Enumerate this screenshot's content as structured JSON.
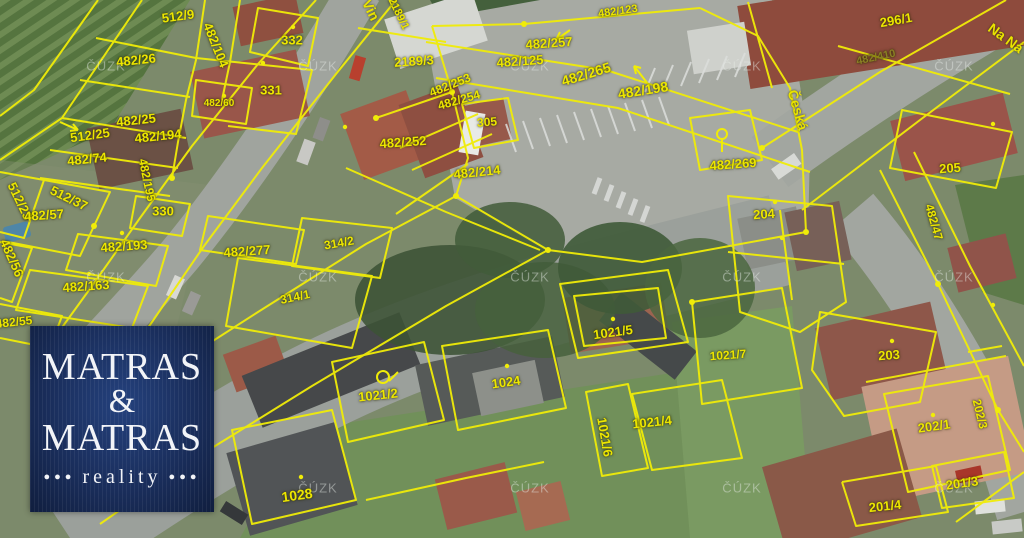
{
  "map": {
    "watermark": {
      "text": "ČÚZK",
      "grid_x": [
        106,
        318,
        530,
        742,
        954
      ],
      "grid_y": [
        66,
        277,
        488
      ]
    },
    "street_labels": [
      {
        "t": "Vin",
        "x": 371,
        "y": 10,
        "r": 64,
        "s": 14
      },
      {
        "t": "Česká",
        "x": 798,
        "y": 110,
        "r": 74,
        "s": 14
      },
      {
        "t": "Na Ná",
        "x": 1006,
        "y": 38,
        "r": 36,
        "s": 14
      }
    ],
    "parcel_labels": [
      {
        "t": "512/9",
        "x": 178,
        "y": 16,
        "r": -8,
        "s": 13
      },
      {
        "t": "482/104",
        "x": 216,
        "y": 45,
        "r": 68,
        "s": 13
      },
      {
        "t": "332",
        "x": 292,
        "y": 40,
        "r": 0,
        "s": 13
      },
      {
        "t": "482/26",
        "x": 136,
        "y": 60,
        "r": -6,
        "s": 13
      },
      {
        "t": "331",
        "x": 271,
        "y": 90,
        "r": 0,
        "s": 13
      },
      {
        "t": "482/60",
        "x": 219,
        "y": 104,
        "r": 0,
        "s": 10
      },
      {
        "t": "482/25",
        "x": 136,
        "y": 120,
        "r": -6,
        "s": 13
      },
      {
        "t": "512/25",
        "x": 90,
        "y": 135,
        "r": -8,
        "s": 13
      },
      {
        "t": "482/194",
        "x": 158,
        "y": 136,
        "r": -6,
        "s": 13
      },
      {
        "t": "482/74",
        "x": 87,
        "y": 159,
        "r": -6,
        "s": 13
      },
      {
        "t": "482/195",
        "x": 147,
        "y": 180,
        "r": 78,
        "s": 12
      },
      {
        "t": "512/23",
        "x": 20,
        "y": 201,
        "r": 64,
        "s": 13
      },
      {
        "t": "512/37",
        "x": 69,
        "y": 198,
        "r": 26,
        "s": 13
      },
      {
        "t": "482/57",
        "x": 44,
        "y": 215,
        "r": -4,
        "s": 13
      },
      {
        "t": "330",
        "x": 163,
        "y": 211,
        "r": 0,
        "s": 13
      },
      {
        "t": "482/193",
        "x": 124,
        "y": 246,
        "r": -4,
        "s": 13
      },
      {
        "t": "482/277",
        "x": 247,
        "y": 251,
        "r": -4,
        "s": 13
      },
      {
        "t": "482/56",
        "x": 12,
        "y": 258,
        "r": 66,
        "s": 13
      },
      {
        "t": "482/163",
        "x": 86,
        "y": 286,
        "r": -4,
        "s": 13
      },
      {
        "t": "314/2",
        "x": 339,
        "y": 243,
        "r": -10,
        "s": 12
      },
      {
        "t": "314/1",
        "x": 295,
        "y": 297,
        "r": -12,
        "s": 12
      },
      {
        "t": "482/55",
        "x": 14,
        "y": 322,
        "r": -6,
        "s": 12
      },
      {
        "t": "2189/1",
        "x": 398,
        "y": 14,
        "r": 64,
        "s": 11
      },
      {
        "t": "2189/3",
        "x": 414,
        "y": 61,
        "r": -4,
        "s": 13
      },
      {
        "t": "482/123",
        "x": 618,
        "y": 12,
        "r": -8,
        "s": 11
      },
      {
        "t": "482/257",
        "x": 549,
        "y": 43,
        "r": -4,
        "s": 13
      },
      {
        "t": "482/125",
        "x": 520,
        "y": 61,
        "r": -4,
        "s": 13
      },
      {
        "t": "482/265",
        "x": 586,
        "y": 74,
        "r": -17,
        "s": 14
      },
      {
        "t": "482/198",
        "x": 643,
        "y": 90,
        "r": -9,
        "s": 14
      },
      {
        "t": "482/253",
        "x": 450,
        "y": 85,
        "r": -22,
        "s": 12
      },
      {
        "t": "482/254",
        "x": 459,
        "y": 100,
        "r": -16,
        "s": 12
      },
      {
        "t": "305",
        "x": 487,
        "y": 122,
        "r": -4,
        "s": 12
      },
      {
        "t": "482/252",
        "x": 403,
        "y": 142,
        "r": -4,
        "s": 13
      },
      {
        "t": "482/214",
        "x": 477,
        "y": 172,
        "r": -6,
        "s": 13
      },
      {
        "t": "296/1",
        "x": 896,
        "y": 20,
        "r": -10,
        "s": 13
      },
      {
        "t": "482/410",
        "x": 876,
        "y": 58,
        "r": -12,
        "s": 11,
        "c": "#8a7f24"
      },
      {
        "t": "482/269",
        "x": 733,
        "y": 164,
        "r": -4,
        "s": 13
      },
      {
        "t": "205",
        "x": 950,
        "y": 168,
        "r": -4,
        "s": 13
      },
      {
        "t": "204",
        "x": 764,
        "y": 214,
        "r": -4,
        "s": 13
      },
      {
        "t": "482/47",
        "x": 934,
        "y": 222,
        "r": 74,
        "s": 12
      },
      {
        "t": "1021/5",
        "x": 613,
        "y": 332,
        "r": -8,
        "s": 13
      },
      {
        "t": "1021/7",
        "x": 728,
        "y": 355,
        "r": -4,
        "s": 12
      },
      {
        "t": "203",
        "x": 889,
        "y": 355,
        "r": -4,
        "s": 13
      },
      {
        "t": "1021/2",
        "x": 378,
        "y": 395,
        "r": -6,
        "s": 13
      },
      {
        "t": "1024",
        "x": 506,
        "y": 382,
        "r": -8,
        "s": 13
      },
      {
        "t": "1021/4",
        "x": 652,
        "y": 422,
        "r": -6,
        "s": 13
      },
      {
        "t": "1021/6",
        "x": 605,
        "y": 437,
        "r": 80,
        "s": 13
      },
      {
        "t": "1028",
        "x": 297,
        "y": 495,
        "r": -8,
        "s": 14
      },
      {
        "t": "202/1",
        "x": 934,
        "y": 426,
        "r": -8,
        "s": 13
      },
      {
        "t": "202/3",
        "x": 980,
        "y": 414,
        "r": 76,
        "s": 12
      },
      {
        "t": "201/3",
        "x": 962,
        "y": 483,
        "r": -8,
        "s": 13
      },
      {
        "t": "201/4",
        "x": 885,
        "y": 506,
        "r": -6,
        "s": 13
      }
    ]
  },
  "logo": {
    "line1": "MATRAS",
    "amp": "&",
    "line2": "MATRAS",
    "tagline": "reality",
    "dots": "●●●"
  },
  "colors": {
    "boundary_yellow": "#f0ec08",
    "label_yellow": "#ece600",
    "logo_navy": "#1a2e5c",
    "logo_text": "#f2f4f8",
    "watermark_grey": "#e4e9e4"
  }
}
